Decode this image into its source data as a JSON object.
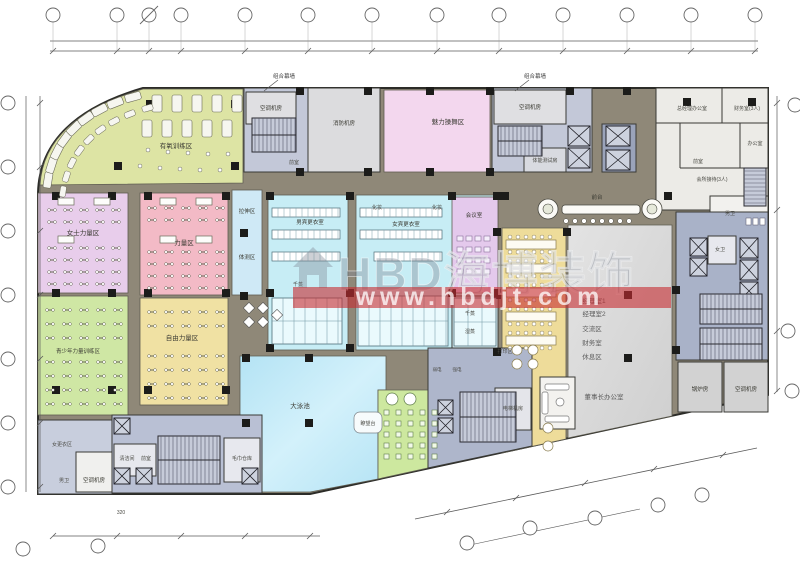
{
  "watermark": {
    "brand": "HBD海博装饰",
    "url": "www.hbdjt.com"
  },
  "facade_notes": {
    "left": "组合幕墙",
    "right": "组合幕墙"
  },
  "dim_note": "320",
  "zones": {
    "aerobic": {
      "label": "有氧训练区",
      "color": "#dde4a4"
    },
    "dance_studio": {
      "label": "魅力操舞区",
      "color": "#f3d7ee"
    },
    "women_strength": {
      "label": "女士力量区",
      "color": "#e8cdeb"
    },
    "strength": {
      "label": "力量区",
      "color": "#f3bac6"
    },
    "youth_training": {
      "label": "青少年力量训练区",
      "color": "#cfe7a4"
    },
    "free_weights": {
      "label": "自由力量区",
      "color": "#f0e1a3"
    },
    "stretch": {
      "label": "拉伸区",
      "color": "#cfe9f6"
    },
    "body_test": {
      "label": "体测区"
    },
    "men_locker": {
      "label": "男宾更衣室",
      "color": "#c7edf5"
    },
    "women_locker": {
      "label": "女宾更衣室"
    },
    "meeting_room": {
      "label": "会议室",
      "color": "#e4c9ec"
    },
    "reception_desk": {
      "label": "前台"
    },
    "pool": {
      "label": "大泳池",
      "color": "#bfe9f7"
    },
    "lifeguard": {
      "label": "瞭望台"
    },
    "leisure_color": "#cde89f",
    "office_color": "#eedc9a",
    "print_area": {
      "label": "打印区"
    },
    "executive": {
      "rooms": [
        "经理室1",
        "经理室2",
        "交流区",
        "财务室",
        "休息区"
      ],
      "chairman_office": "董事长办公室"
    }
  },
  "rooms": {
    "ac_nw": "空调机房",
    "fire_room": "消防机房",
    "vestibule_nw": "前室",
    "ac_n": "空调机房",
    "fitness_test": "体能测试房",
    "vestibule_ne": "前室",
    "gm_office": "总经理办公室",
    "finance_office": "财务室(3人)",
    "office": "办公室",
    "club_reception": "会所接待(3人)",
    "men_wc_ne": "男卫",
    "women_wc_e": "女卫",
    "boiler": "锅炉房",
    "ac_e": "空调机房",
    "strong_elec": "强电",
    "weak_elec": "弱电",
    "elevator_machine": "电梯机房",
    "dry_sauna_m": "千蒸",
    "dry_sauna_w": "千蒸",
    "wet_sauna_w": "湿蒸",
    "makeup_1": "化妆",
    "makeup_2": "化妆",
    "cleaning": "清洁间",
    "vestibule_s": "前室",
    "towel_storage": "毛巾仓库",
    "ac_sw": "空调机房",
    "men_wc_sw": "男卫",
    "women_changing": "女更衣区"
  }
}
